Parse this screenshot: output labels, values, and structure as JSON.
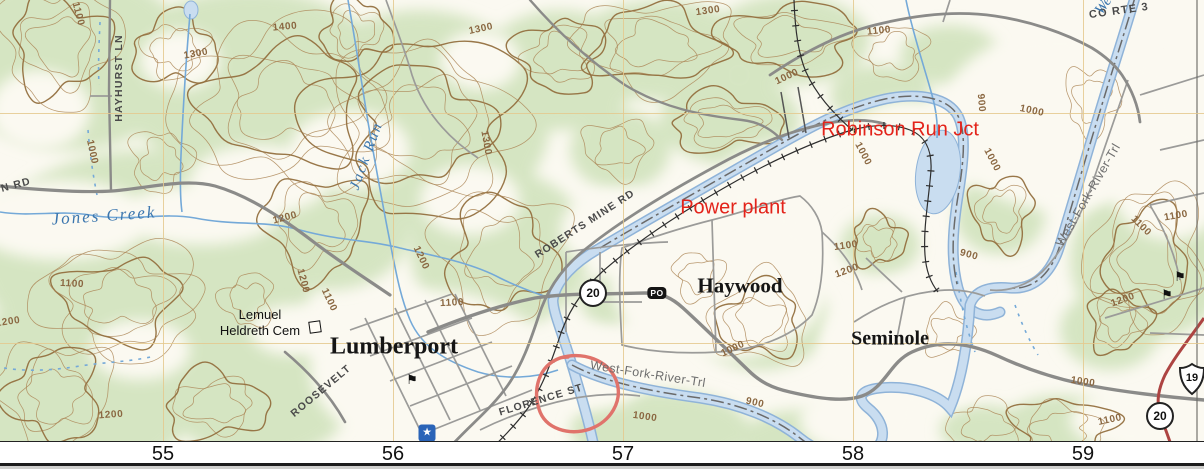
{
  "map": {
    "annotations": {
      "robinson_run_jct": "Robinson Run Jct",
      "power_plant": "Power plant"
    },
    "places": {
      "lumberport": "Lumberport",
      "haywood": "Haywood",
      "seminole": "Seminole",
      "cemetery_line1": "Lemuel",
      "cemetery_line2": "Heldreth Cem"
    },
    "roads": {
      "hayhurst_ln": "HAYHURST LN",
      "n_rd": "N RD",
      "co_rte_3": "CO RTE 3",
      "roberts_mine_rd": "ROBERTS MINE RD",
      "roosevelt": "ROOSEVELT",
      "florence_st": "FLORENCE ST"
    },
    "trails": {
      "west_fork_river_trl_1": "West-Fork-River-Trl",
      "west_fork_river_trl_2": "West-Fork-River-Trl"
    },
    "water": {
      "jones_creek": "Jones Creek",
      "jack_run": "Jack Run",
      "west_fork_partial": "We"
    },
    "shields": {
      "route20_a": "20",
      "route20_b": "20",
      "us19": "19",
      "post_office": "PO"
    },
    "contour_labels": [
      {
        "text": "1100",
        "x": 78,
        "y": 14,
        "r": 75
      },
      {
        "text": "1400",
        "x": 285,
        "y": 27,
        "r": -5
      },
      {
        "text": "1300",
        "x": 196,
        "y": 54,
        "r": -10
      },
      {
        "text": "1300",
        "x": 481,
        "y": 29,
        "r": -12
      },
      {
        "text": "1300",
        "x": 708,
        "y": 11,
        "r": -8
      },
      {
        "text": "1300",
        "x": 486,
        "y": 143,
        "r": 80
      },
      {
        "text": "1100",
        "x": 879,
        "y": 31,
        "r": -6
      },
      {
        "text": "1000",
        "x": 787,
        "y": 77,
        "r": -25
      },
      {
        "text": "900",
        "x": 981,
        "y": 103,
        "r": 85
      },
      {
        "text": "1000",
        "x": 1032,
        "y": 111,
        "r": 12
      },
      {
        "text": "1000",
        "x": 863,
        "y": 154,
        "r": 62
      },
      {
        "text": "1000",
        "x": 992,
        "y": 160,
        "r": 62
      },
      {
        "text": "1100",
        "x": 1141,
        "y": 226,
        "r": 45
      },
      {
        "text": "1100",
        "x": 1176,
        "y": 216,
        "r": -10
      },
      {
        "text": "1000",
        "x": 92,
        "y": 152,
        "r": 78
      },
      {
        "text": "1100",
        "x": 72,
        "y": 284,
        "r": 3
      },
      {
        "text": "1200",
        "x": 8,
        "y": 322,
        "r": -8
      },
      {
        "text": "1200",
        "x": 285,
        "y": 218,
        "r": -15
      },
      {
        "text": "1200",
        "x": 303,
        "y": 281,
        "r": 75
      },
      {
        "text": "1100",
        "x": 329,
        "y": 300,
        "r": 65
      },
      {
        "text": "1200",
        "x": 421,
        "y": 258,
        "r": 65
      },
      {
        "text": "1100",
        "x": 452,
        "y": 303,
        "r": -3
      },
      {
        "text": "1200",
        "x": 111,
        "y": 415,
        "r": -4
      },
      {
        "text": "1100",
        "x": 846,
        "y": 246,
        "r": -8
      },
      {
        "text": "1200",
        "x": 847,
        "y": 271,
        "r": -20
      },
      {
        "text": "900",
        "x": 969,
        "y": 255,
        "r": 15
      },
      {
        "text": "900",
        "x": 755,
        "y": 403,
        "r": 12
      },
      {
        "text": "1000",
        "x": 645,
        "y": 417,
        "r": 8
      },
      {
        "text": "1000",
        "x": 733,
        "y": 349,
        "r": -25
      },
      {
        "text": "1000",
        "x": 1083,
        "y": 382,
        "r": 8
      },
      {
        "text": "1100",
        "x": 1110,
        "y": 420,
        "r": -12
      },
      {
        "text": "1200",
        "x": 1123,
        "y": 300,
        "r": -20
      }
    ],
    "colors": {
      "woodland_green": "#d5e5c2",
      "background": "#fbf9f1",
      "contour_brown": "#ad8758",
      "index_contour": "#94703f",
      "river_fill": "#c9ddf0",
      "river_edge": "#8fb3d8",
      "road_gray": "#8b8b89",
      "us_highway_red": "#ad4442",
      "annotation_red": "#e3231a",
      "grid_tan": "#e4c98e"
    }
  },
  "axis": {
    "values": [
      {
        "label": "55",
        "x": 163
      },
      {
        "label": "56",
        "x": 393
      },
      {
        "label": "57",
        "x": 623
      },
      {
        "label": "58",
        "x": 853
      },
      {
        "label": "59",
        "x": 1083
      }
    ]
  }
}
